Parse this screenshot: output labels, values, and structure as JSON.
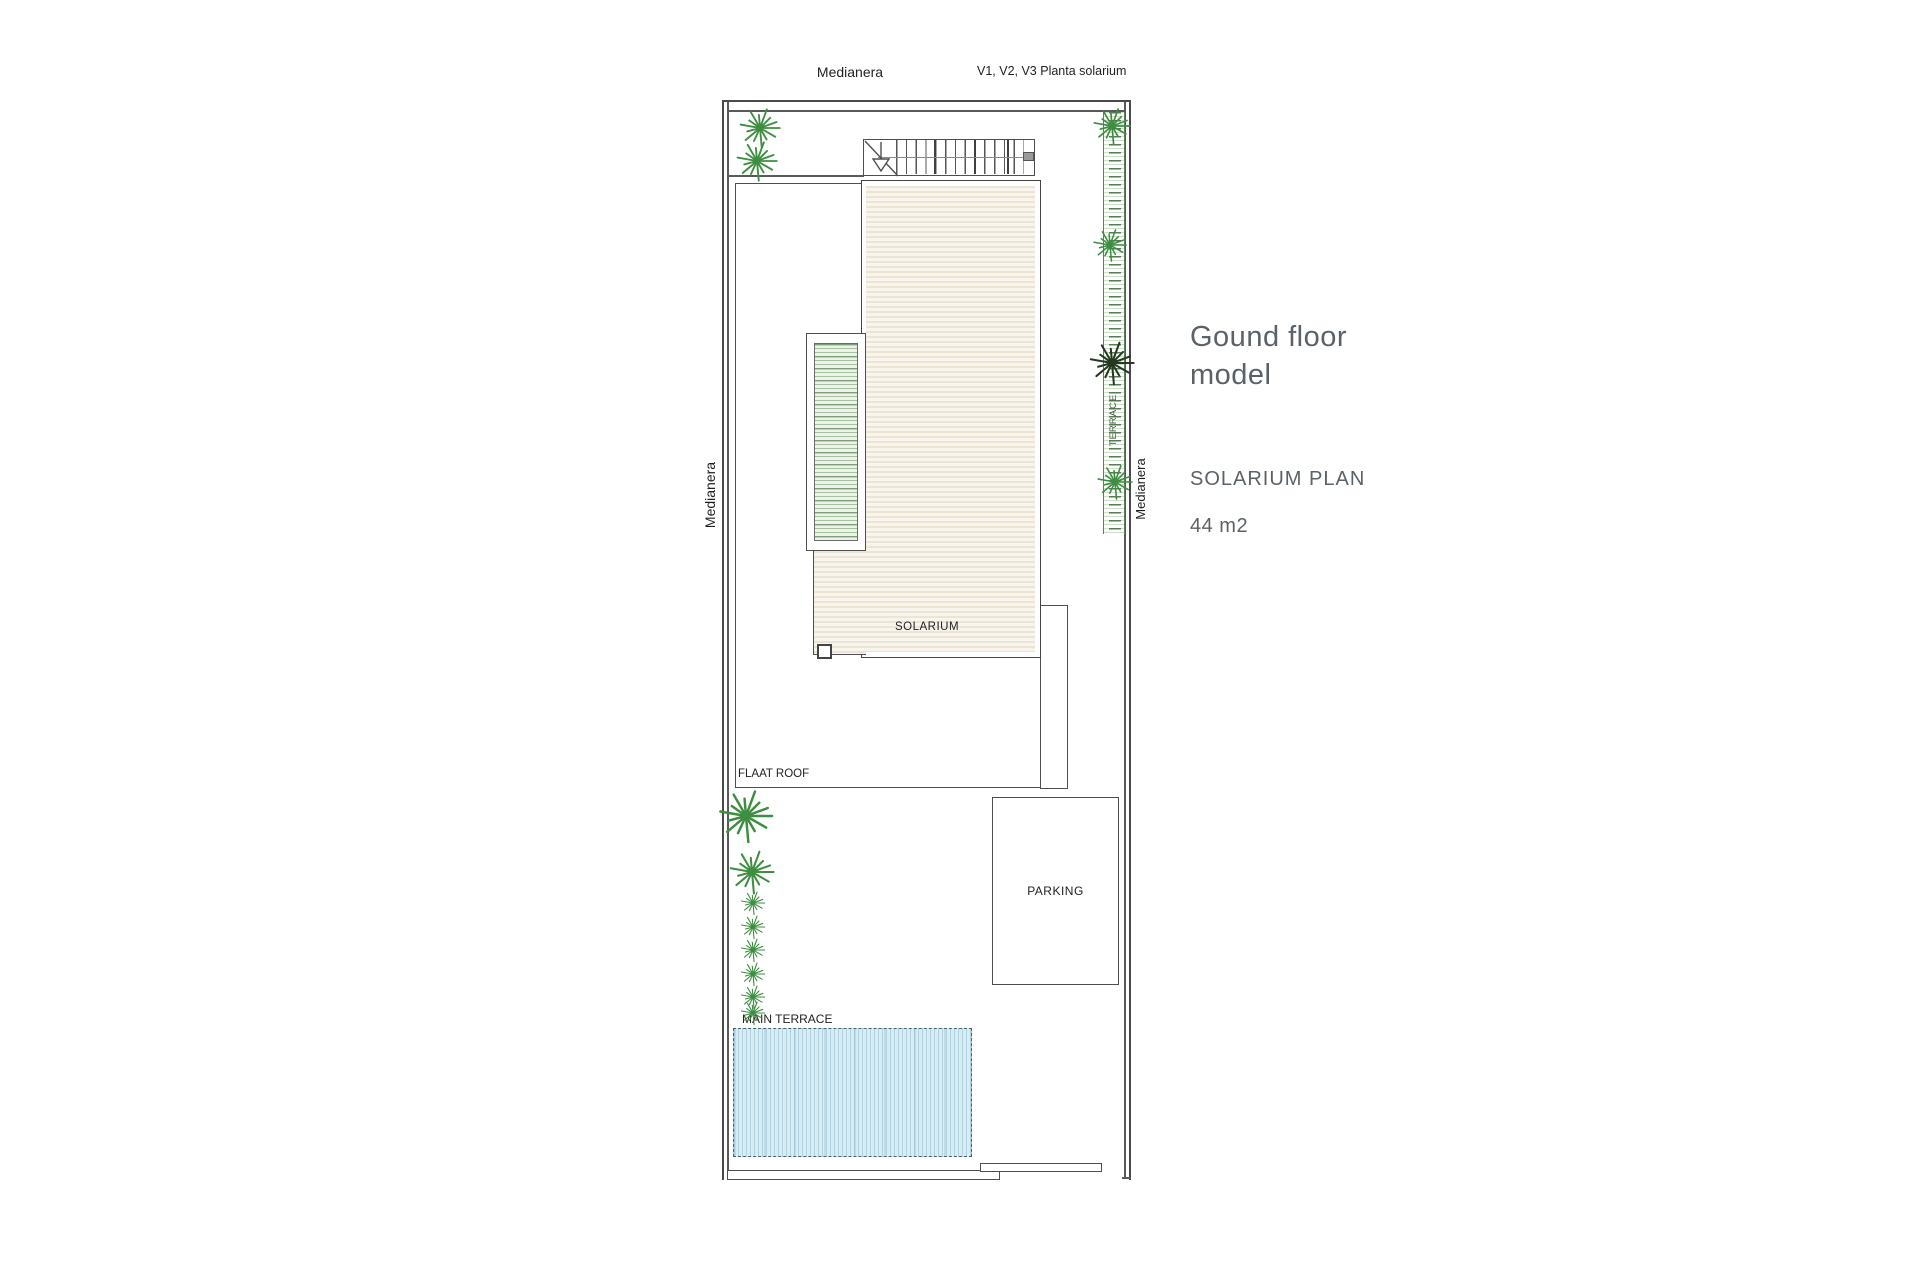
{
  "plan": {
    "top_label": "Medianera",
    "top_right_label": "V1, V2, V3 Planta solarium",
    "left_label": "Medianera",
    "right_label": "Medianera",
    "terrace_label": "TERRACE",
    "solarium_label": "SOLARIUM",
    "flat_roof_label": "FLAAT ROOF",
    "parking_label": "PARKING",
    "main_terrace_label": "MAIN TERRACE"
  },
  "side_panel": {
    "title": "Gound floor model",
    "plan_name": "SOLARIUM PLAN",
    "area": "44 m2"
  },
  "colors": {
    "wall": "#4a4a4a",
    "deck": "#f4f0e7",
    "pool": "#d8ecf4",
    "pergola_green": "#b7cfb2",
    "hedge_green": "#5d7f5b",
    "plant_green": "#3e8e41",
    "plant_dark": "#24391f",
    "text_gray": "#5b6267"
  }
}
